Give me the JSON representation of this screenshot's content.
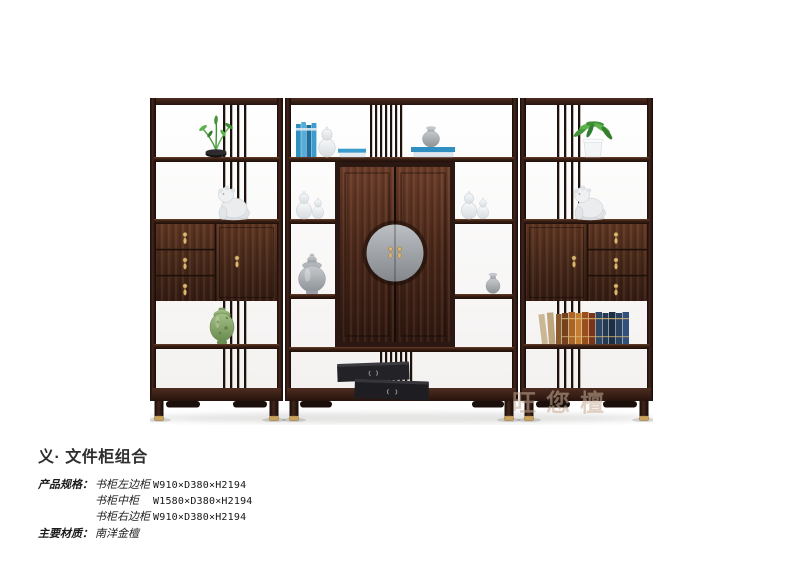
{
  "page": {
    "background": "#ffffff"
  },
  "artwork": {
    "watermark": "旺您檀",
    "decor_items": [
      "potted-plant",
      "foo-dog-statue",
      "blue-books",
      "white-gourd-vases",
      "gray-jar",
      "temple-jar",
      "green-vase",
      "leather-books",
      "black-boxes",
      "white-planter-plant",
      "small-gray-vase"
    ]
  },
  "product": {
    "title": "义· 文件柜组合",
    "specs_label": "产品规格：",
    "specs": [
      {
        "name": "书柜左边柜",
        "dims": "W910×D380×H2194"
      },
      {
        "name": "书柜中柜",
        "dims": "W1580×D380×H2194"
      },
      {
        "name": "书柜右边柜",
        "dims": "W910×D380×H2194"
      }
    ],
    "material_label": "主要材质：",
    "material": "南洋金檀"
  },
  "palette": {
    "wood_dark": "#241310",
    "wood_mid": "#4a2a1e",
    "wood_face": "#57321f",
    "brass": "#d9b873",
    "book_blue": "#2e8fc0",
    "porcelain_gray": "#9aa0a6",
    "plant_green": "#4e9a3e",
    "vase_green": "#8fae6f",
    "medallion_gray": "#9b9fa4",
    "text": "#2e2e2e",
    "watermark_color": "rgba(198,172,150,0.55)"
  }
}
